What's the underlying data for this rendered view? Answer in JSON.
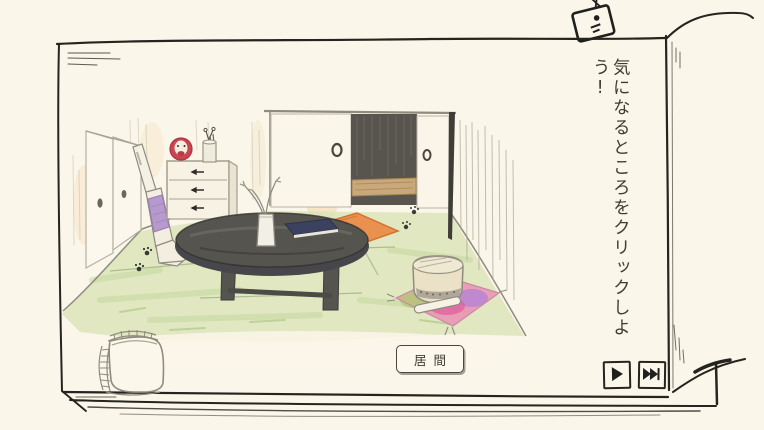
{
  "app": {
    "type": "hand-drawn point-and-click game",
    "scene_name": "living-room"
  },
  "instruction": {
    "text": "気になるところをクリックしよう!",
    "orientation": "vertical"
  },
  "room_label": {
    "text": "居間"
  },
  "nav": {
    "play_button": {
      "icon": "play-icon"
    },
    "fast_forward_button": {
      "icon": "fast-forward-icon"
    }
  },
  "scene": {
    "objects": [
      {
        "id": "closet-sliding-doors"
      },
      {
        "id": "stick-vacuum"
      },
      {
        "id": "chest-of-drawers"
      },
      {
        "id": "daruma-doll"
      },
      {
        "id": "pen-cup"
      },
      {
        "id": "fusuma-doorway-open"
      },
      {
        "id": "flower-vase"
      },
      {
        "id": "round-low-table"
      },
      {
        "id": "notebook"
      },
      {
        "id": "orange-floor-cushion"
      },
      {
        "id": "bell-with-striker-on-pink-cushion"
      },
      {
        "id": "cat-paw-prints"
      },
      {
        "id": "woven-basket"
      },
      {
        "id": "tv-doodle"
      }
    ]
  },
  "colors": {
    "paper": "#faf6e9",
    "ink": "#26241f",
    "tatami_green": "#d9e4b6",
    "cushion_orange": "#eb9150",
    "cushion_pink": "#ea8fb4",
    "vacuum_purple": "#b69ace",
    "daruma_red": "#cb4550",
    "wood_tan": "#c9a87b",
    "table_gray": "#55544e",
    "book_navy": "#3a4260",
    "text_gray": "#413d33"
  }
}
